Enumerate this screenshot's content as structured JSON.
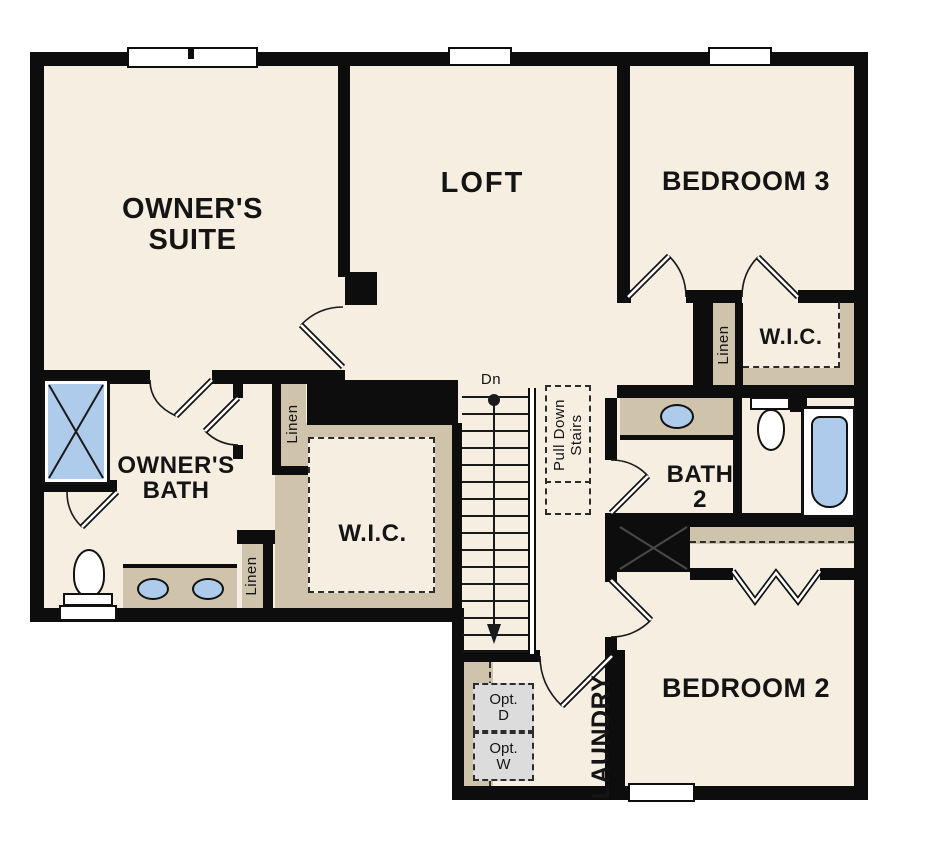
{
  "rooms": {
    "owners_suite": "OWNER'S SUITE",
    "loft": "LOFT",
    "bedroom3": "BEDROOM 3",
    "bedroom2": "BEDROOM 2",
    "owners_bath": "OWNER'S BATH",
    "bath2": "BATH 2",
    "wic_owners": "W.I.C.",
    "wic_bedroom3": "W.I.C.",
    "laundry": "LAUNDRY"
  },
  "closets": {
    "linen_hall": "Linen",
    "linen_bath": "Linen",
    "linen_bedroom3": "Linen"
  },
  "stairs": {
    "down": "Dn",
    "pull_down": "Pull Down Stairs"
  },
  "laundry_appliances": {
    "optional_dryer": "Opt. D",
    "optional_washer": "Opt. W"
  },
  "colors": {
    "floor": "#f5eee1",
    "wall": "#0d0d0d",
    "cabinet": "#cfc3ab",
    "fixture_blue": "#aecbec",
    "appliance_fill": "#dcdcdc"
  }
}
